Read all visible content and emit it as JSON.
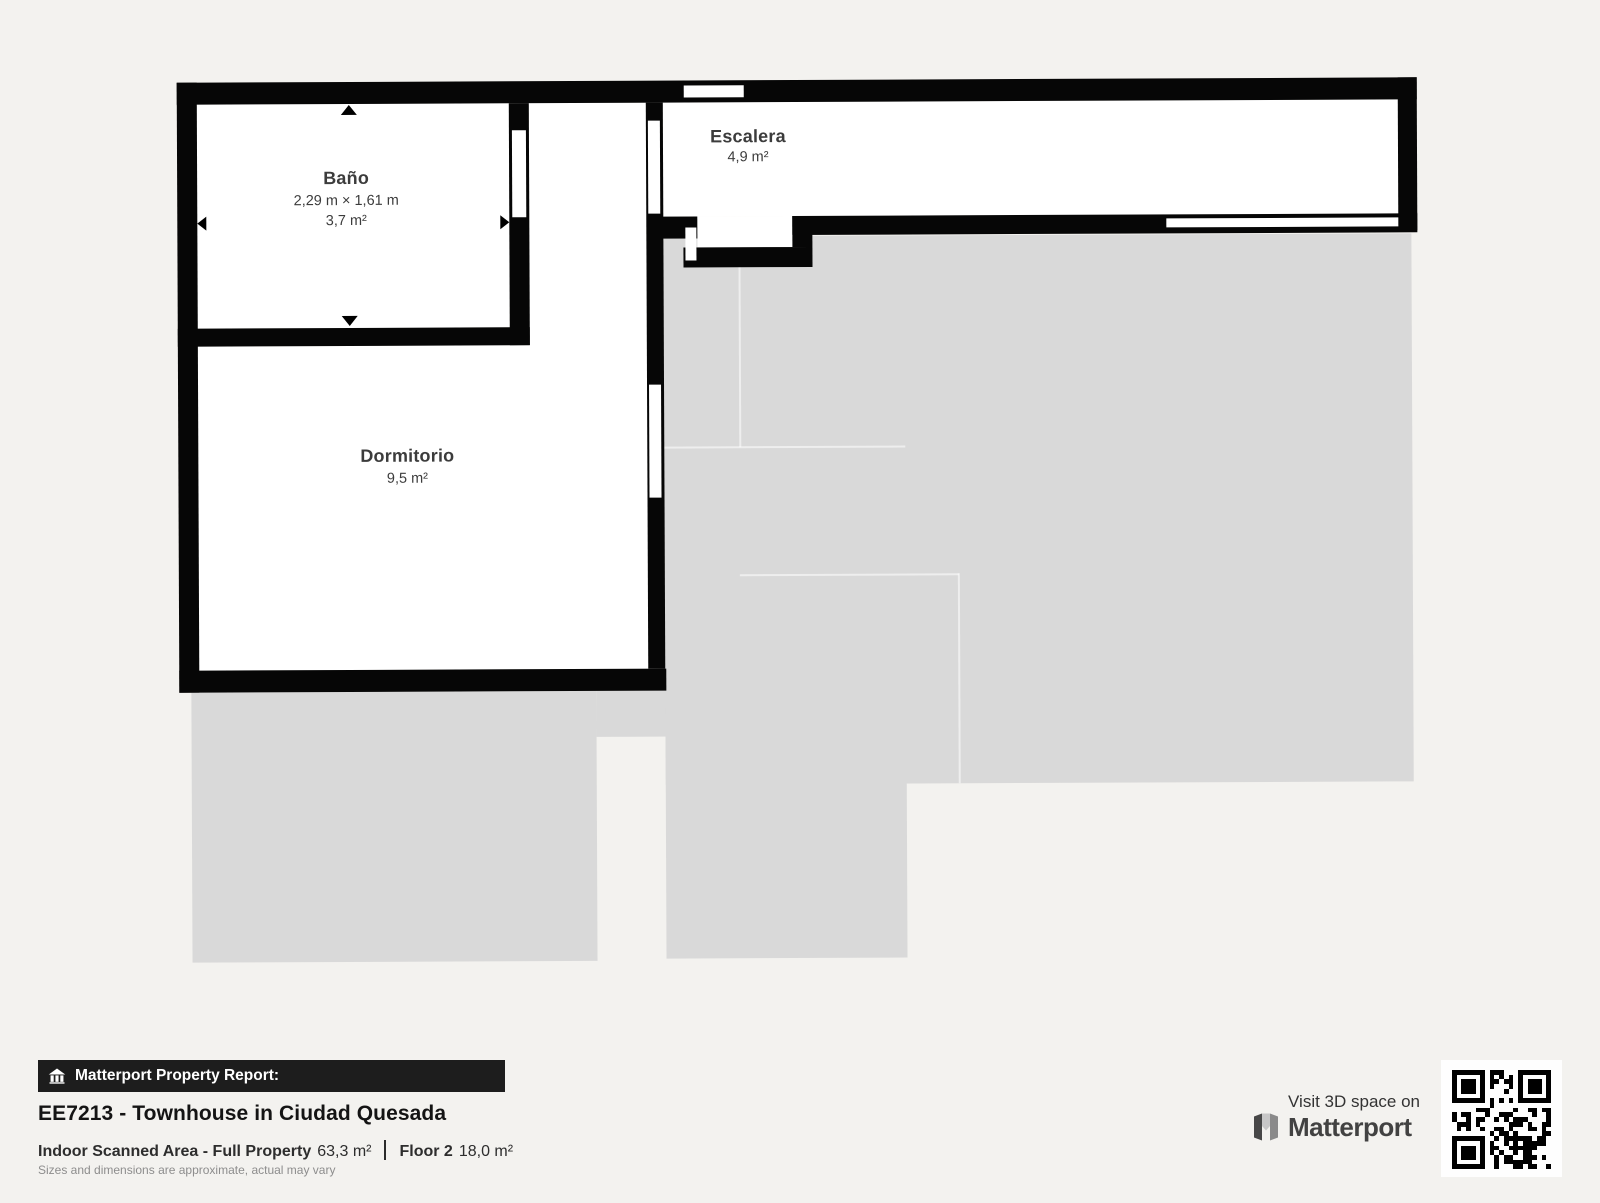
{
  "floorplan": {
    "rooms": [
      {
        "name": "Baño",
        "dimensions": "2,29 m × 1,61 m",
        "area": "3,7 m²"
      },
      {
        "name": "Dormitorio",
        "area": "9,5 m²"
      },
      {
        "name": "Escalera",
        "area": "4,9 m²"
      }
    ]
  },
  "footer": {
    "badge": "Matterport Property Report:",
    "property_title": "EE7213 - Townhouse in Ciudad Quesada",
    "scanned_area_label": "Indoor Scanned Area - Full Property",
    "scanned_area_value": "63,3 m²",
    "floor_label": "Floor 2",
    "floor_value": "18,0 m²",
    "disclaimer": "Sizes and dimensions are approximate, actual may vary"
  },
  "branding": {
    "visit_text": "Visit 3D space on",
    "brand_name": "Matterport"
  },
  "icons": {
    "badge_icon": "home-icon",
    "brand_icon": "matterport-m-icon",
    "qr": "qr-code"
  },
  "colors": {
    "background": "#f3f2ef",
    "wall": "#060606",
    "floor_underlay": "#d9d9d9",
    "room_fill": "#ffffff",
    "label_text": "#3c3c3c",
    "badge_bg": "#1d1d1d"
  }
}
